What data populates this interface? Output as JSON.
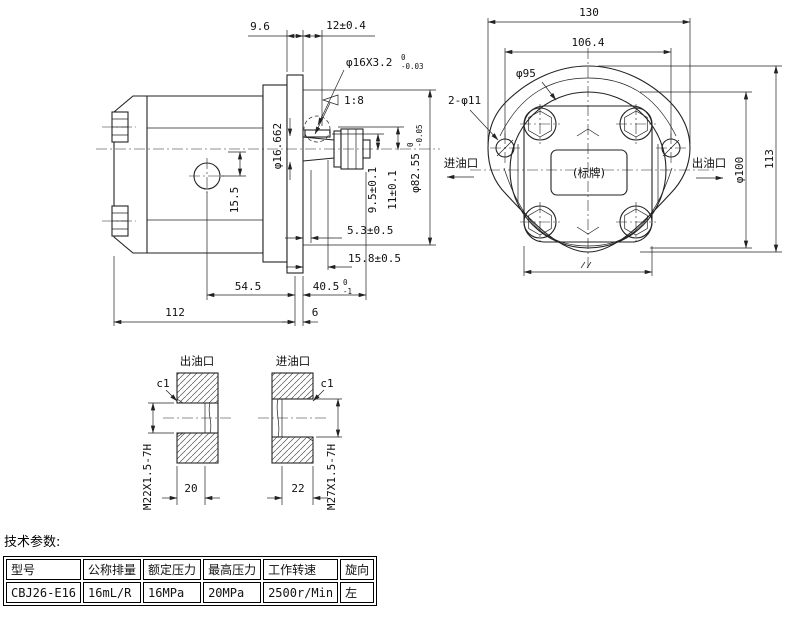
{
  "side_view": {
    "dim_flange_thickness": "9.6",
    "dim_shaft_ext": "12±0.4",
    "thread_callout_main": "φ16X3.2",
    "thread_callout_tol_top": "0",
    "thread_callout_tol_bottom": "-0.03",
    "taper_ratio": "1:8",
    "dim_taper_gauge_dia": "φ16.662",
    "dim_drain_offset": "15.5",
    "dim_key_9_5": "9.5±0.1",
    "dim_key_11": "11±0.1",
    "spigot_dia_main": "φ82.55",
    "spigot_dia_tol_top": "0",
    "spigot_dia_tol_bottom": "-0.05",
    "dim_5_3": "5.3±0.5",
    "dim_15_8": "15.8±0.5",
    "dim_54_5": "54.5",
    "dim_40_5_main": "40.5",
    "dim_40_5_tol_top": "0",
    "dim_40_5_tol_bottom": "-1",
    "dim_112": "112",
    "dim_6": "6"
  },
  "front_view": {
    "dim_width": "130",
    "dim_bolt_spacing": "106.4",
    "dim_bolt_circle": "φ95",
    "mount_holes_callout": "2-φ11",
    "label_inlet": "进油口",
    "label_outlet": "出油口",
    "nameplate": "(标牌)",
    "dim_body_dia": "φ100",
    "dim_height": "113"
  },
  "ports": {
    "outlet": {
      "title": "出油口",
      "chamfer": "c1",
      "thread": "M22X1.5-7H",
      "depth": "20"
    },
    "inlet": {
      "title": "进油口",
      "chamfer": "c1",
      "thread": "M27X1.5-7H",
      "depth": "22"
    }
  },
  "specs": {
    "title": "技术参数:",
    "headers": [
      "型号",
      "公称排量",
      "额定压力",
      "最高压力",
      "工作转速",
      "旋向"
    ],
    "values": [
      "CBJ26-E16",
      "16mL/R",
      "16MPa",
      "20MPa",
      "2500r/Min",
      "左"
    ]
  }
}
